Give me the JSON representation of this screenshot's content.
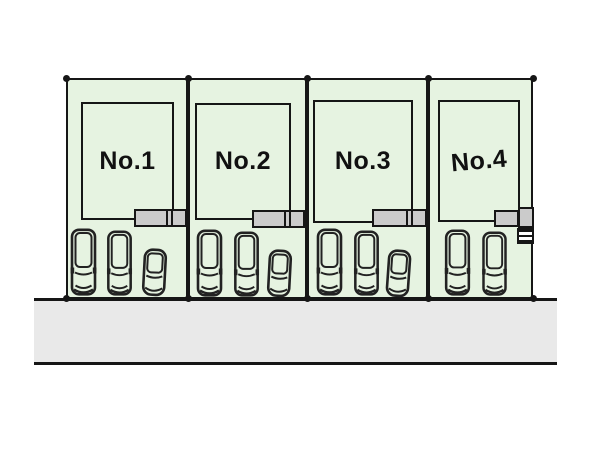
{
  "diagram": {
    "type": "real-estate-site-plan",
    "colors": {
      "lot_fill": "#e6f3e1",
      "porch_fill": "#cbcbcb",
      "road_fill": "#e9e9e9",
      "line": "#161616"
    },
    "lots": [
      {
        "label": "No.1",
        "cars": [
          "van",
          "van",
          "compact"
        ]
      },
      {
        "label": "No.2",
        "cars": [
          "van",
          "van",
          "compact"
        ]
      },
      {
        "label": "No.3",
        "cars": [
          "van",
          "van",
          "compact"
        ]
      },
      {
        "label": "No.4",
        "cars": [
          "van",
          "van"
        ]
      }
    ],
    "road": {
      "name": "road"
    }
  }
}
